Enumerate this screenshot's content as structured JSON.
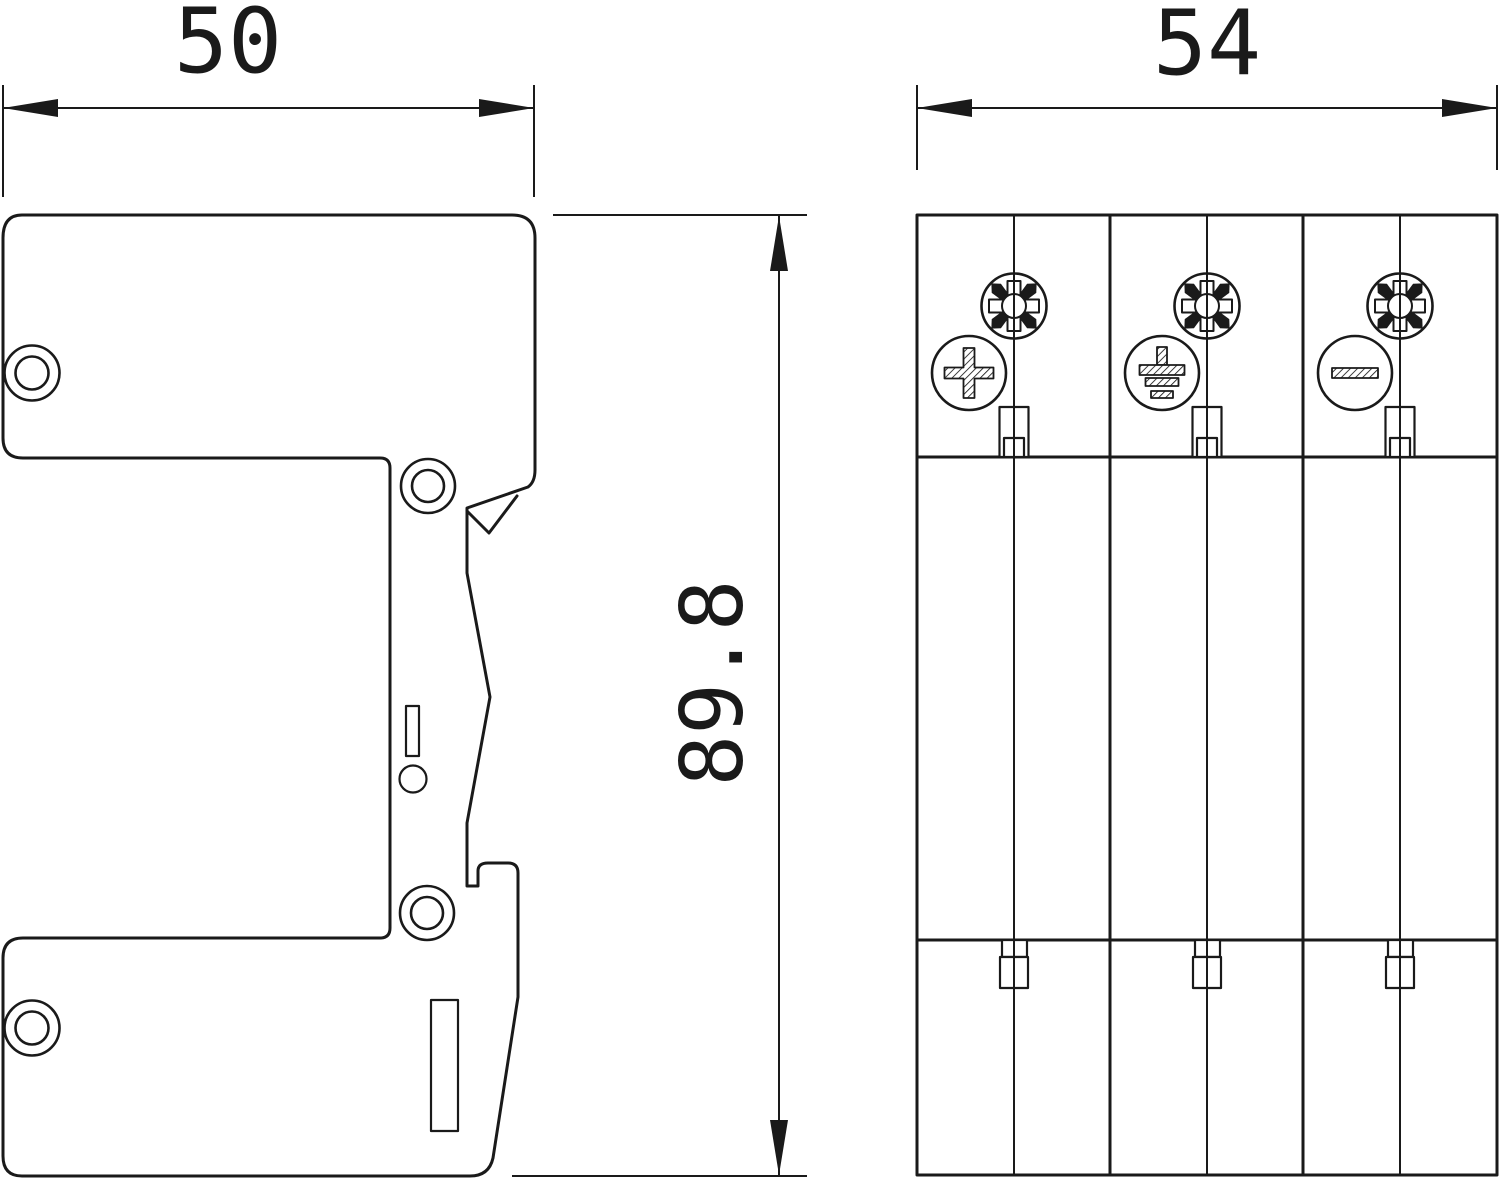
{
  "drawing": {
    "kind": "technical-dimension-drawing",
    "line_color": "#1a1a1a",
    "background": "#ffffff",
    "dimensions": {
      "side_width_mm": "50",
      "front_width_mm": "54",
      "height_mm": "89.8"
    },
    "views": {
      "side_view": {
        "name": "side-profile",
        "screw_holes": 4,
        "has_din_rail_clip": true
      },
      "front_view": {
        "name": "front",
        "screw_type": "pozidriv",
        "modules": [
          {
            "terminal_symbol": "plus"
          },
          {
            "terminal_symbol": "protective-earth"
          },
          {
            "terminal_symbol": "minus"
          }
        ]
      }
    }
  }
}
